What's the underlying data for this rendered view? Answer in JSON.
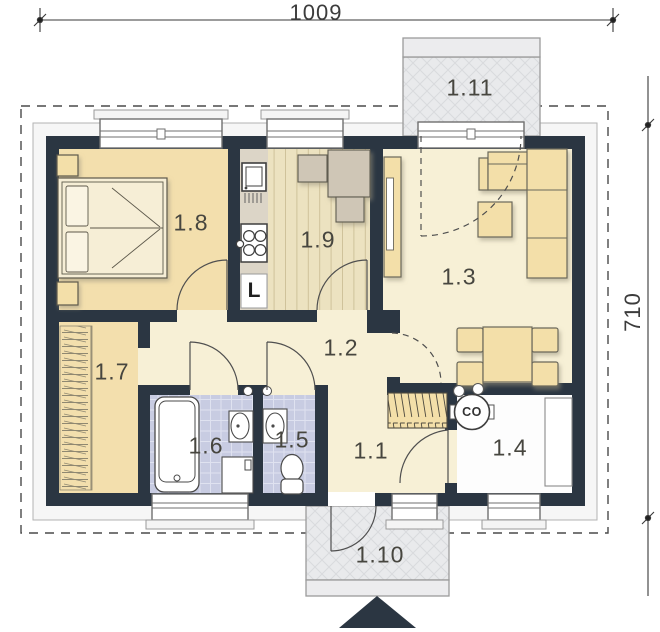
{
  "plan": {
    "title": "floor-plan",
    "dimensions": {
      "width_label": "1009",
      "height_label": "710"
    },
    "rooms": [
      {
        "number": "1.8"
      },
      {
        "number": "1.9"
      },
      {
        "number": "1.3"
      },
      {
        "number": "1.2"
      },
      {
        "number": "1.7"
      },
      {
        "number": "1.6"
      },
      {
        "number": "1.5"
      },
      {
        "number": "1.1"
      },
      {
        "number": "1.4"
      },
      {
        "number": "1.10"
      },
      {
        "number": "1.11"
      }
    ],
    "markers": {
      "fridge": "L",
      "boiler": "CO"
    },
    "colors": {
      "wall": "#2b3642",
      "warm_floor": "#f3dfad",
      "hall_floor": "#f7f0d6",
      "tile_floor": "#c8cce2",
      "utility_floor": "#fdfdfd",
      "terrace": "#e9eaec",
      "furniture": "#f3dfa9",
      "kitchen_set": "#cfc6b6"
    }
  }
}
